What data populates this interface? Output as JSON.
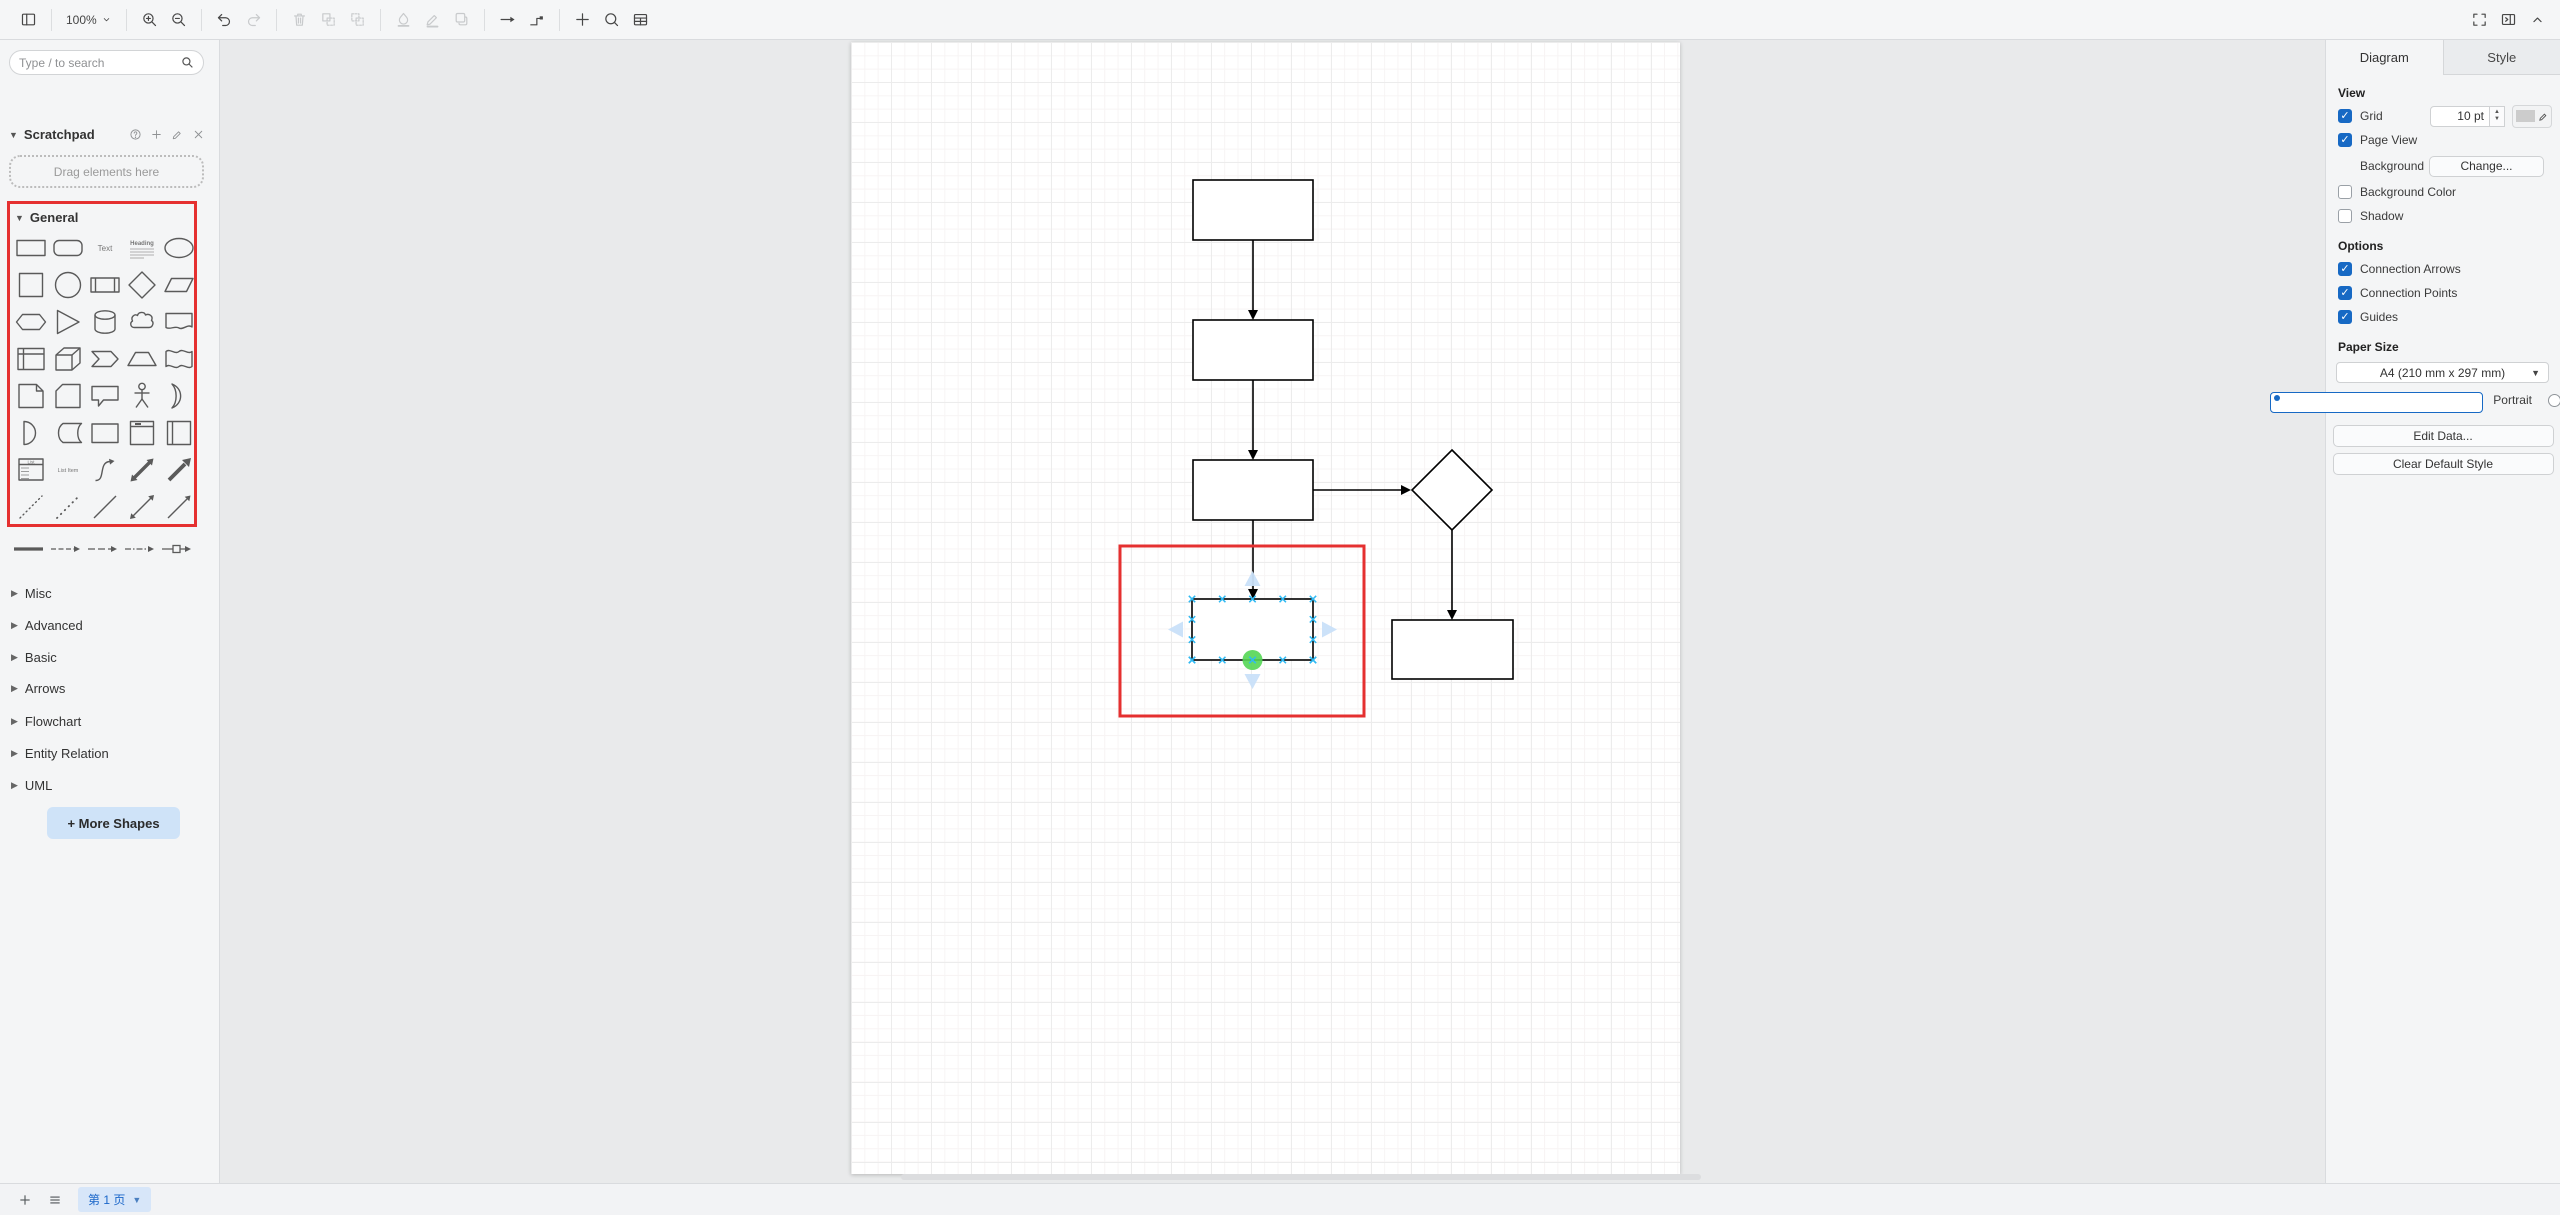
{
  "toolbar": {
    "zoom_level": "100%",
    "items": [
      {
        "name": "toggle-shapes-panel",
        "icon": "sidebar-toggle"
      },
      {
        "sep": true
      },
      {
        "name": "zoom-level",
        "icon": "chevron-down",
        "label_key": "zoom_level"
      },
      {
        "sep": true
      },
      {
        "name": "zoom-in",
        "icon": "zoom-in"
      },
      {
        "name": "zoom-out",
        "icon": "zoom-out"
      },
      {
        "sep": true
      },
      {
        "name": "undo",
        "icon": "undo"
      },
      {
        "name": "redo",
        "icon": "redo",
        "disabled": true
      },
      {
        "sep": true
      },
      {
        "name": "delete",
        "icon": "trash",
        "disabled": true
      },
      {
        "name": "to-front",
        "icon": "to-front",
        "disabled": true
      },
      {
        "name": "to-back",
        "icon": "to-back",
        "disabled": true
      },
      {
        "sep": true
      },
      {
        "name": "fill-color",
        "icon": "fill-color",
        "disabled": true
      },
      {
        "name": "line-color",
        "icon": "line-color",
        "disabled": true
      },
      {
        "name": "shadow",
        "icon": "shadow",
        "disabled": true
      },
      {
        "sep": true
      },
      {
        "name": "connection",
        "icon": "connection-arrow"
      },
      {
        "name": "waypoints",
        "icon": "waypoints"
      },
      {
        "sep": true
      },
      {
        "name": "insert",
        "icon": "plus"
      },
      {
        "name": "freehand",
        "icon": "freehand"
      },
      {
        "name": "table",
        "icon": "table"
      }
    ],
    "right_items": [
      {
        "name": "fullscreen",
        "icon": "fullscreen"
      },
      {
        "name": "toggle-format-panel",
        "icon": "panel-right"
      },
      {
        "name": "collapse-expand",
        "icon": "chevron-up"
      }
    ]
  },
  "sidebar": {
    "search_placeholder": "Type / to search",
    "scratchpad": {
      "title": "Scratchpad",
      "icons": [
        "help",
        "add",
        "edit",
        "close"
      ],
      "drop_hint": "Drag elements here"
    },
    "general": {
      "title": "General",
      "glyph_labels": {
        "text": "Text",
        "heading": "Heading",
        "list_item": "List Item",
        "list_title": "List"
      },
      "shapes": [
        "rectangle",
        "rounded-rectangle",
        "text",
        "textbox",
        "ellipse",
        "square",
        "circle",
        "process",
        "diamond",
        "parallelogram",
        "hexagon",
        "triangle",
        "cylinder",
        "cloud",
        "document",
        "internal-storage",
        "cube",
        "step",
        "trapezoid",
        "tape",
        "note",
        "card",
        "callout",
        "actor",
        "or",
        "and",
        "data-storage",
        "container",
        "vertical-container",
        "horizontal-container",
        "list",
        "list-item",
        "curve",
        "bidirectional-arrow",
        "arrow",
        "dashed-line",
        "dotted-line",
        "line",
        "bidirectional-connector",
        "directional-connector"
      ]
    },
    "edge_styles": [
      "link",
      "thin-arrow",
      "dashed-arrow",
      "dash-dot-arrow",
      "labeled-arrow"
    ],
    "sections": [
      "Misc",
      "Advanced",
      "Basic",
      "Arrows",
      "Flowchart",
      "Entity Relation",
      "UML"
    ],
    "more_shapes_label": "+ More Shapes"
  },
  "format": {
    "tabs": [
      {
        "label": "Diagram",
        "active": true
      },
      {
        "label": "Style",
        "active": false
      }
    ],
    "view": {
      "heading": "View",
      "grid_label": "Grid",
      "grid_checked": true,
      "grid_size": "10 pt",
      "page_view_label": "Page View",
      "page_view_checked": true,
      "background_label": "Background",
      "change_button": "Change...",
      "background_color_label": "Background Color",
      "background_color_checked": false,
      "shadow_label": "Shadow",
      "shadow_checked": false
    },
    "options": {
      "heading": "Options",
      "items": [
        {
          "label": "Connection Arrows",
          "checked": true
        },
        {
          "label": "Connection Points",
          "checked": true
        },
        {
          "label": "Guides",
          "checked": true
        }
      ]
    },
    "paper": {
      "heading": "Paper Size",
      "value": "A4 (210 mm x 297 mm)",
      "portrait_label": "Portrait",
      "portrait_selected": true,
      "landscape_label": "Landscape",
      "landscape_selected": false
    },
    "edit_data_label": "Edit Data...",
    "clear_style_label": "Clear Default Style"
  },
  "pages": {
    "current": "第 1 页"
  },
  "canvas": {
    "colors": {
      "shape_stroke": "#000000",
      "group_highlight": "#e53030",
      "connection_point": "#30b9f2",
      "direction_arrow": "#c9e0f9",
      "endpoint_handle": "#54d654"
    },
    "diagram": {
      "rects": [
        {
          "x": 342,
          "y": 138,
          "w": 120,
          "h": 60
        },
        {
          "x": 342,
          "y": 278,
          "w": 120,
          "h": 60
        },
        {
          "x": 342,
          "y": 418,
          "w": 120,
          "h": 60
        },
        {
          "x": 541,
          "y": 578,
          "w": 121,
          "h": 59
        }
      ],
      "diamond": {
        "cx": 601,
        "cy": 448,
        "rx": 40,
        "ry": 40
      },
      "selected_rect": {
        "x": 341,
        "y": 557,
        "w": 121,
        "h": 61
      },
      "group_rect": {
        "x": 269,
        "y": 504,
        "w": 244,
        "h": 170
      },
      "edges": [
        {
          "x1": 402,
          "y1": 198,
          "x2": 402,
          "y2": 278,
          "dir": "down"
        },
        {
          "x1": 402,
          "y1": 338,
          "x2": 402,
          "y2": 418,
          "dir": "down"
        },
        {
          "x1": 462,
          "y1": 448,
          "x2": 560,
          "y2": 448,
          "dir": "right"
        },
        {
          "x1": 601,
          "y1": 488,
          "x2": 601,
          "y2": 578,
          "dir": "down"
        },
        {
          "x1": 402,
          "y1": 478,
          "x2": 402,
          "y2": 557,
          "dir": "down"
        }
      ]
    }
  }
}
